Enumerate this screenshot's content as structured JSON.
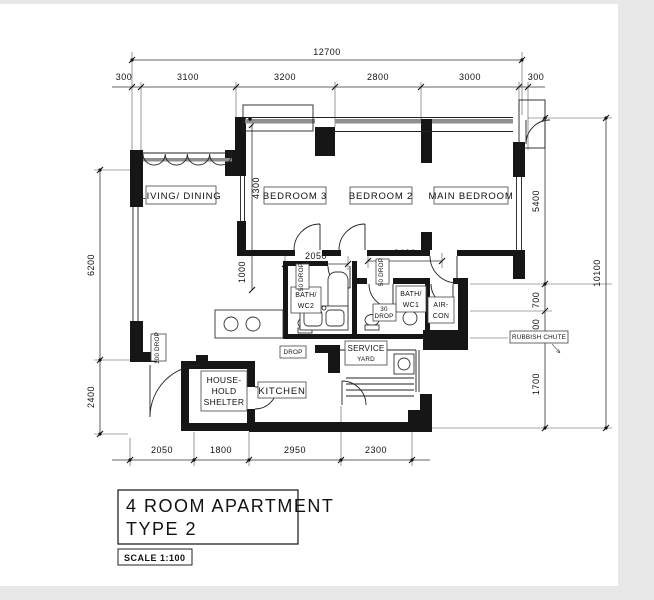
{
  "title_block": {
    "line1": "4 ROOM APARTMENT",
    "line2": "TYPE 2",
    "scale": "SCALE  1:100"
  },
  "rooms": {
    "living_dining": "LIVING/ DINING",
    "bedroom3": "BEDROOM 3",
    "bedroom2": "BEDROOM 2",
    "main_bedroom": "MAIN BEDROOM",
    "bath_wc2_l1": "BATH/",
    "bath_wc2_l2": "WC2",
    "bath_wc1_l1": "BATH/",
    "bath_wc1_l2": "WC1",
    "aircon_l1": "AIR-",
    "aircon_l2": "CON",
    "household_l1": "HOUSE-",
    "household_l2": "HOLD",
    "household_l3": "SHELTER",
    "kitchen": "KITCHEN",
    "service_l1": "SERVICE",
    "service_l2": "YARD"
  },
  "annotations": {
    "drop_50_a": "50 DROP",
    "drop_50_b": "50 DROP",
    "drop_30_l1": "30",
    "drop_30_l2": "DROP",
    "drop_100": "100 DROP",
    "drop_kitchen": "DROP",
    "rubbish_chute": "RUBBISH CHUTE"
  },
  "dimensions": {
    "top_total": "12700",
    "top_segments": [
      "300",
      "3100",
      "3200",
      "2800",
      "3000",
      "300"
    ],
    "left_segments": [
      "6200",
      "2400"
    ],
    "right_segments": [
      "5400",
      "700",
      "800",
      "1700"
    ],
    "right_total": "10100",
    "bottom_segments": [
      "2050",
      "1800",
      "2950",
      "2300"
    ],
    "inner_bath2_width": "2050",
    "inner_hall_width": "2400",
    "inner_bed3_depth": "4300",
    "inner_hall_depth": "1000"
  }
}
